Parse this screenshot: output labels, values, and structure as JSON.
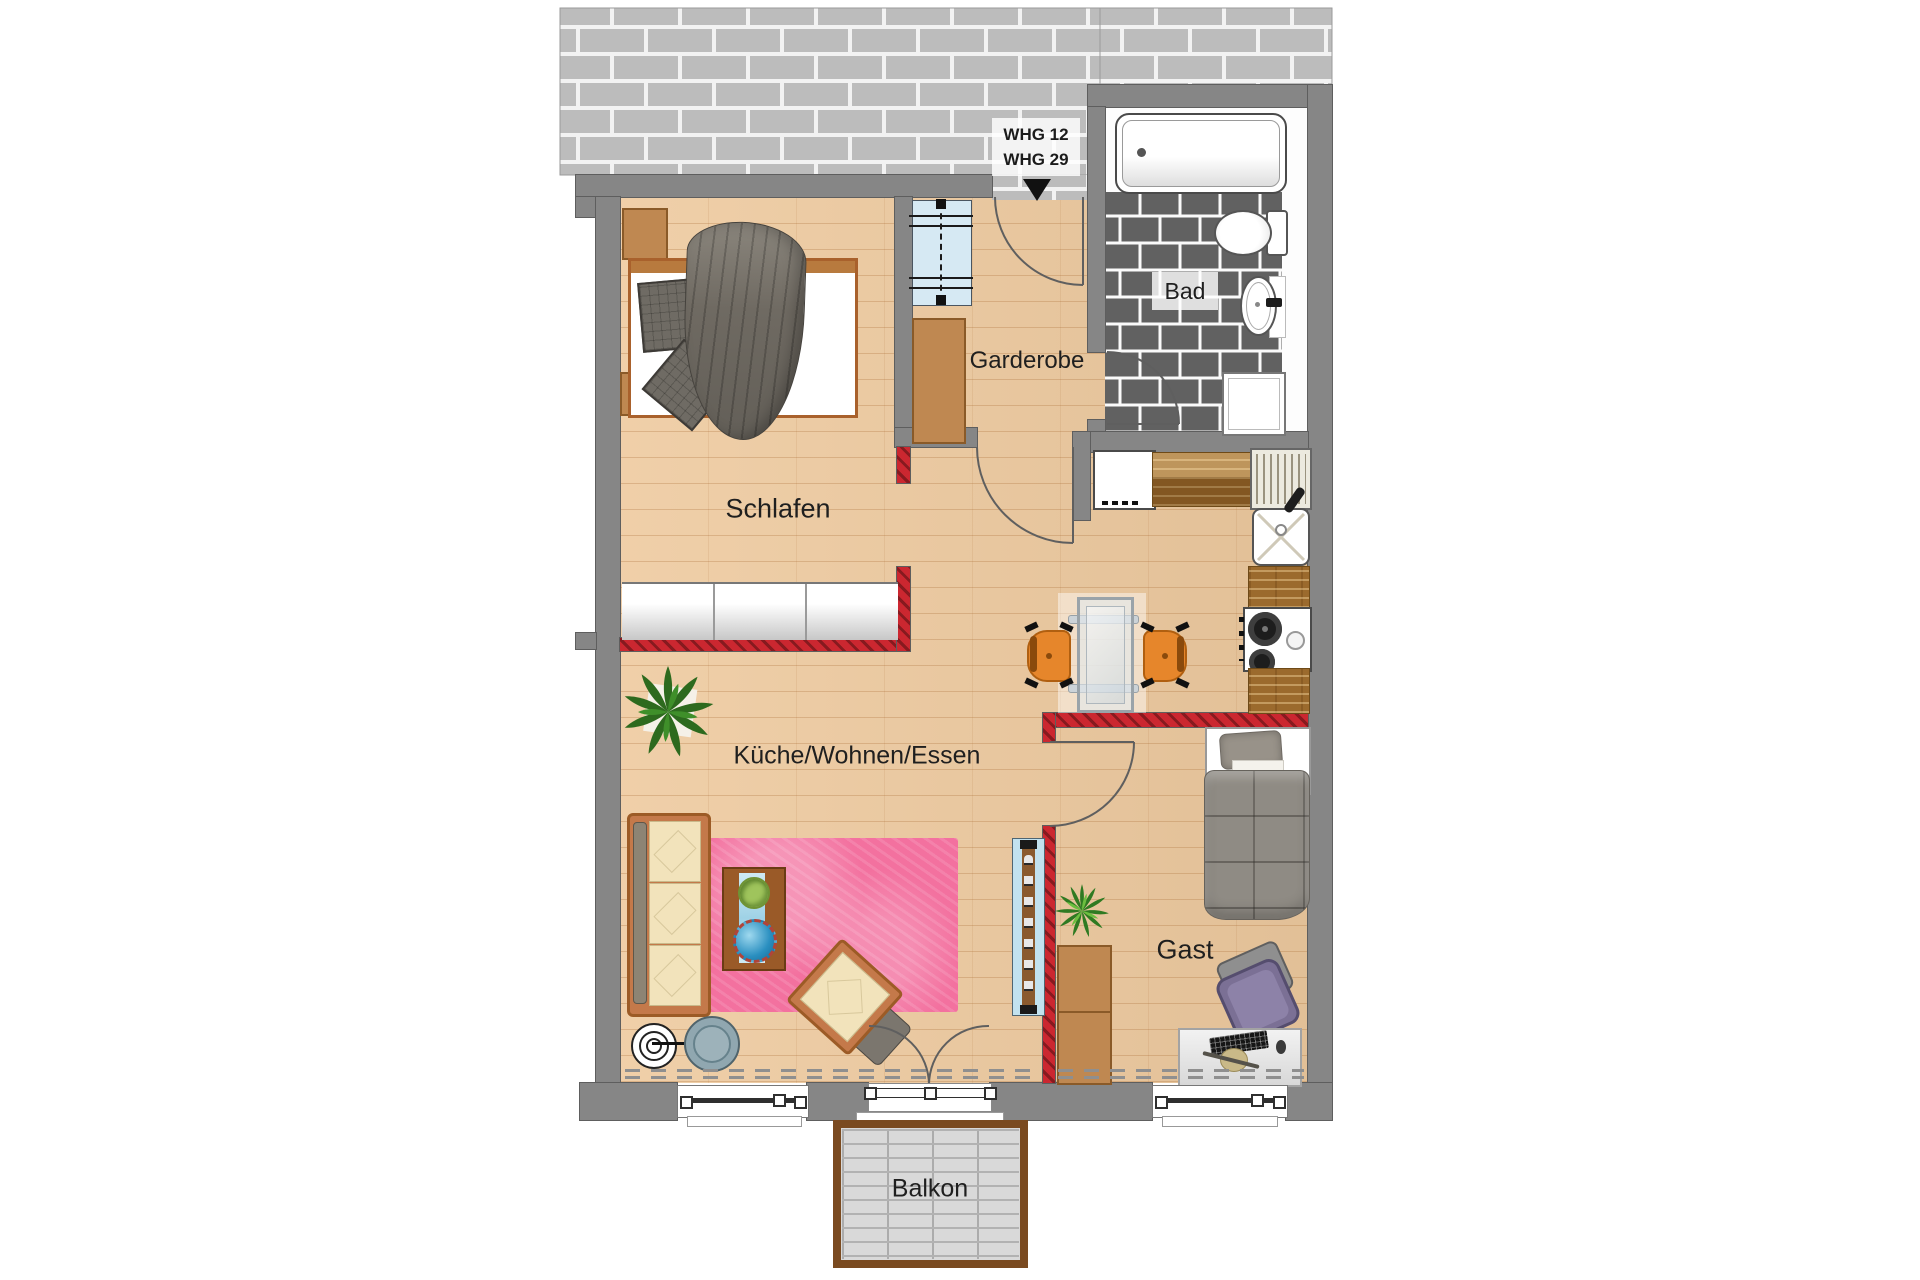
{
  "labels": {
    "unit_line1": "WHG 12",
    "unit_line2": "WHG 29",
    "bathroom": "Bad",
    "hall": "Garderobe",
    "bedroom": "Schlafen",
    "living": "Küche/Wohnen/Essen",
    "guest": "Gast",
    "balcony": "Balkon"
  },
  "colors": {
    "wall_gray": "#868686",
    "stairwell_brick": "#bcbcbc",
    "bath_tile": "#616161",
    "new_wall_red": "#c9252c",
    "floor_wood": "#eeca9f",
    "rug_pink": "#f3719f",
    "balcony_frame": "#7a4a20",
    "deck_gray": "#d9d9d9",
    "chair_orange": "#e6862b",
    "plant_green": "#2d6a1e"
  }
}
